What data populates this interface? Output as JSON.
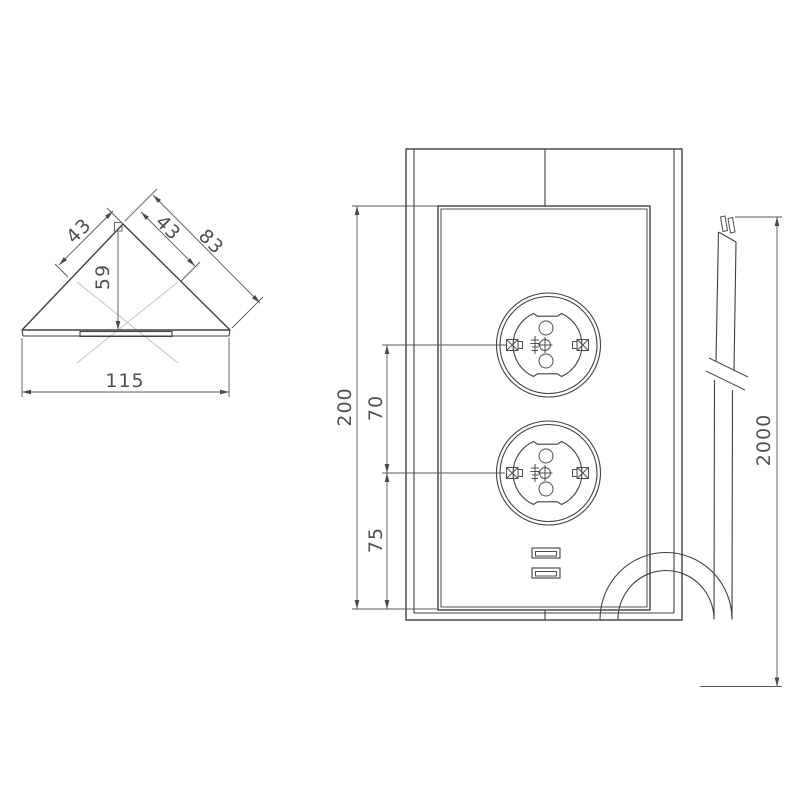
{
  "top_view": {
    "edge_left": "43",
    "edge_right": "43",
    "edge_outer": "83",
    "depth": "59",
    "width": "115"
  },
  "front_view": {
    "height": "200",
    "socket_spacing": "70",
    "bottom_offset": "75"
  },
  "cable": {
    "length": "2000"
  }
}
